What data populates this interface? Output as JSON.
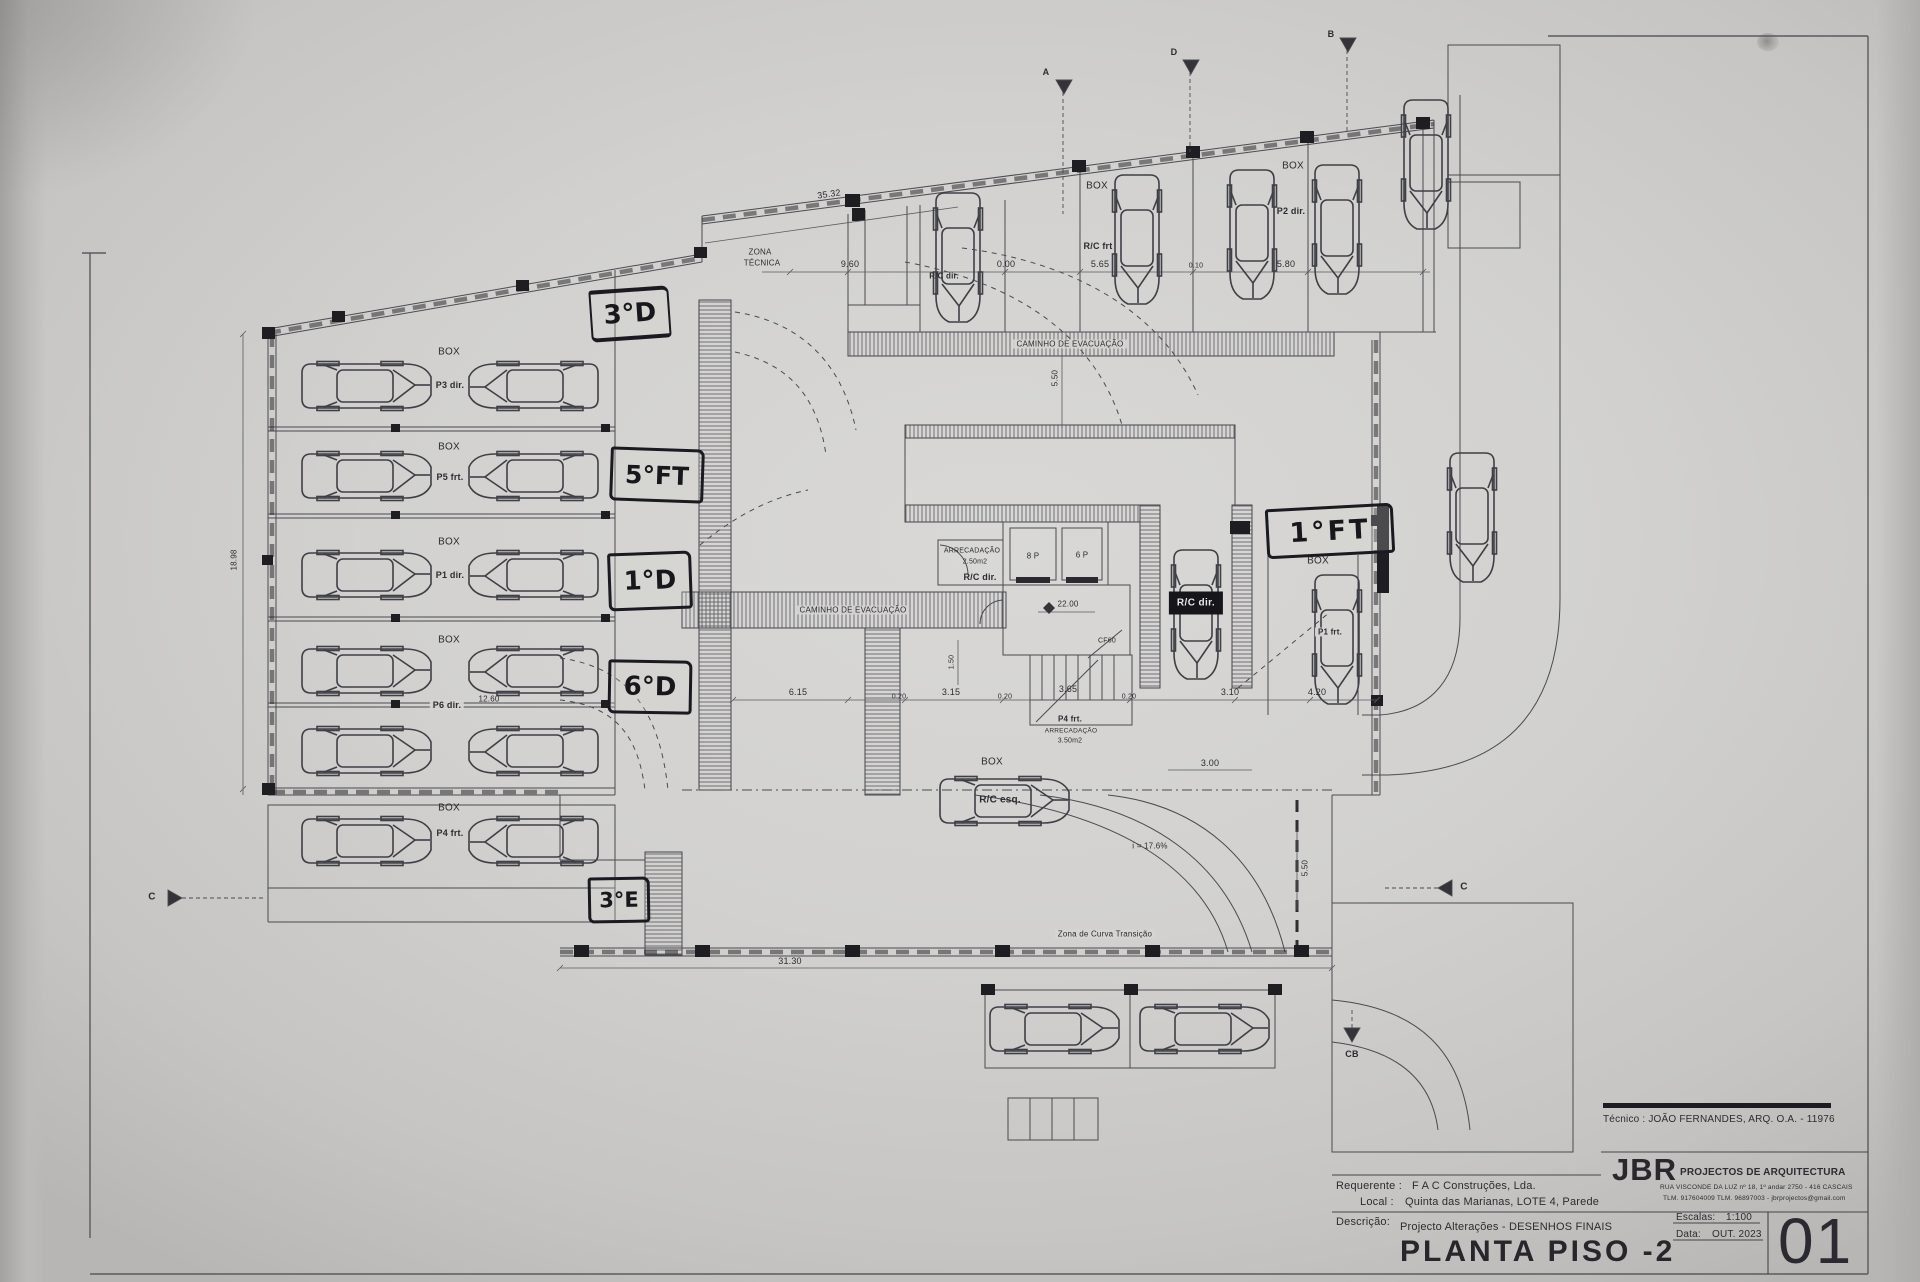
{
  "sheet": {
    "tecnico": "Técnico : JOÃO FERNANDES, ARQ.   O.A. - 11976",
    "firm_initials": "JBR",
    "firm_name": "PROJECTOS DE ARQUITECTURA",
    "firm_address": "RUA VISCONDE DA LUZ nº 18, 1º andar  2750 - 416 CASCAIS",
    "firm_contact": "TLM. 917604009  TLM. 96897003 - jbrprojectos@gmail.com",
    "requerente_label": "Requerente :",
    "requerente": "F A C  Construções, Lda.",
    "local_label": "Local :",
    "local": "Quinta das Marianas, LOTE 4, Parede",
    "descricao_label": "Descrição:",
    "descricao": "Projecto Alterações - DESENHOS FINAIS",
    "title": "PLANTA PISO -2",
    "escalas_label": "Escalas:",
    "escala": "1:100",
    "data_label": "Data:",
    "data": "OUT. 2023",
    "number": "01"
  },
  "handwritten": {
    "a1": "3°D",
    "a2": "5°FT",
    "a3": "1°D",
    "a4": "6°D",
    "a5": "3°E",
    "a6": "1°FT"
  },
  "labels": {
    "box": "BOX",
    "zona_tecnica_1": "ZONA",
    "zona_tecnica_2": "TÉCNICA",
    "caminho": "CAMINHO DE EVACUAÇÃO",
    "arrecadacao": "ARRECADAÇÃO",
    "arrec_area_1": "2.50m2",
    "arrec_area_2": "3.50m2",
    "rc_dir": "R/C dir.",
    "rc_esq": "R/C esq.",
    "rc_frt": "R/C frt",
    "p1": "P1 dir.",
    "p2": "P2 dir.",
    "p3": "P3 dir.",
    "p4": "P4 frt.",
    "p5": "P5 frt.",
    "p6": "P6 dir.",
    "p1f": "P1 frt.",
    "lift8": "8 P",
    "lift6": "6 P",
    "door": "CF60",
    "slope": "i = 17.6%",
    "curve_note": "Zona de Curva Transição"
  },
  "dims": {
    "top": "35.32",
    "d960": "9.60",
    "d000": "0.00",
    "d565": "5.65",
    "d010": "0.10",
    "d580": "5.80",
    "left": "18.98",
    "d1260": "12.60",
    "d615": "6.15",
    "d020": "0.20",
    "d315": "3.15",
    "d365": "3.65",
    "d310": "3.10",
    "d420": "4.20",
    "d150": "1.50",
    "d300": "3.00",
    "d550": "5.50",
    "bottom": "31.30",
    "level": "22.00"
  },
  "sections": {
    "s1": "A",
    "s2": "D",
    "s3": "B",
    "s4": "C",
    "s5": "C",
    "s6": "CB"
  }
}
